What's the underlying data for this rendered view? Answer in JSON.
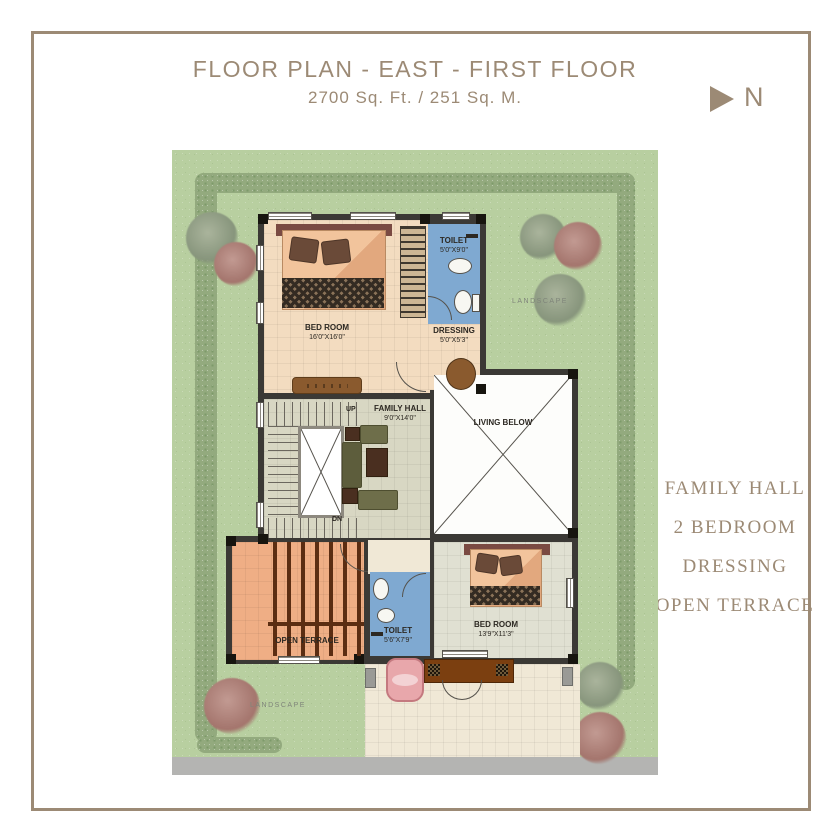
{
  "header": {
    "title": "FLOOR PLAN - EAST - FIRST FLOOR",
    "subtitle": "2700 Sq. Ft. / 251 Sq. M.",
    "north_label": "N"
  },
  "legend": {
    "items": [
      {
        "label": "FAMILY HALL"
      },
      {
        "label": "2 BEDROOM"
      },
      {
        "label": "DRESSING"
      },
      {
        "label": "OPEN TERRACE"
      }
    ]
  },
  "plan": {
    "rooms": {
      "bedroom1": {
        "name": "BED ROOM",
        "dims": "16'0\"X16'0\""
      },
      "toilet1": {
        "name": "TOILET",
        "dims": "5'0\"X9'0\""
      },
      "dressing": {
        "name": "DRESSING",
        "dims": "5'0\"X5'3\""
      },
      "family_hall": {
        "name": "FAMILY HALL",
        "dims": "9'0\"X14'0\""
      },
      "living_below": {
        "name": "LIVING BELOW"
      },
      "open_terrace": {
        "name": "OPEN TERRACE"
      },
      "bedroom2": {
        "name": "BED ROOM",
        "dims": "13'9\"X11'3\""
      },
      "toilet2": {
        "name": "TOILET",
        "dims": "5'6\"X7'9\""
      }
    },
    "stairs": {
      "up_label": "UP",
      "dn_label": "DN"
    },
    "landscape_label": "LANDSCAPE"
  },
  "colors": {
    "accent_taupe": "#9C8A75",
    "lawn_green": "#B8CFA0",
    "hedge_green": "#93AA7E",
    "wall_dark": "#3B3935",
    "toilet_blue": "#7FA9D1",
    "bedroom_peach": "#F3DCC0",
    "hall_tile": "#D8D7C3",
    "terrace_salmon": "#EFAE85",
    "beam_brown": "#5B2D12",
    "road_gray": "#B4B4B2"
  }
}
